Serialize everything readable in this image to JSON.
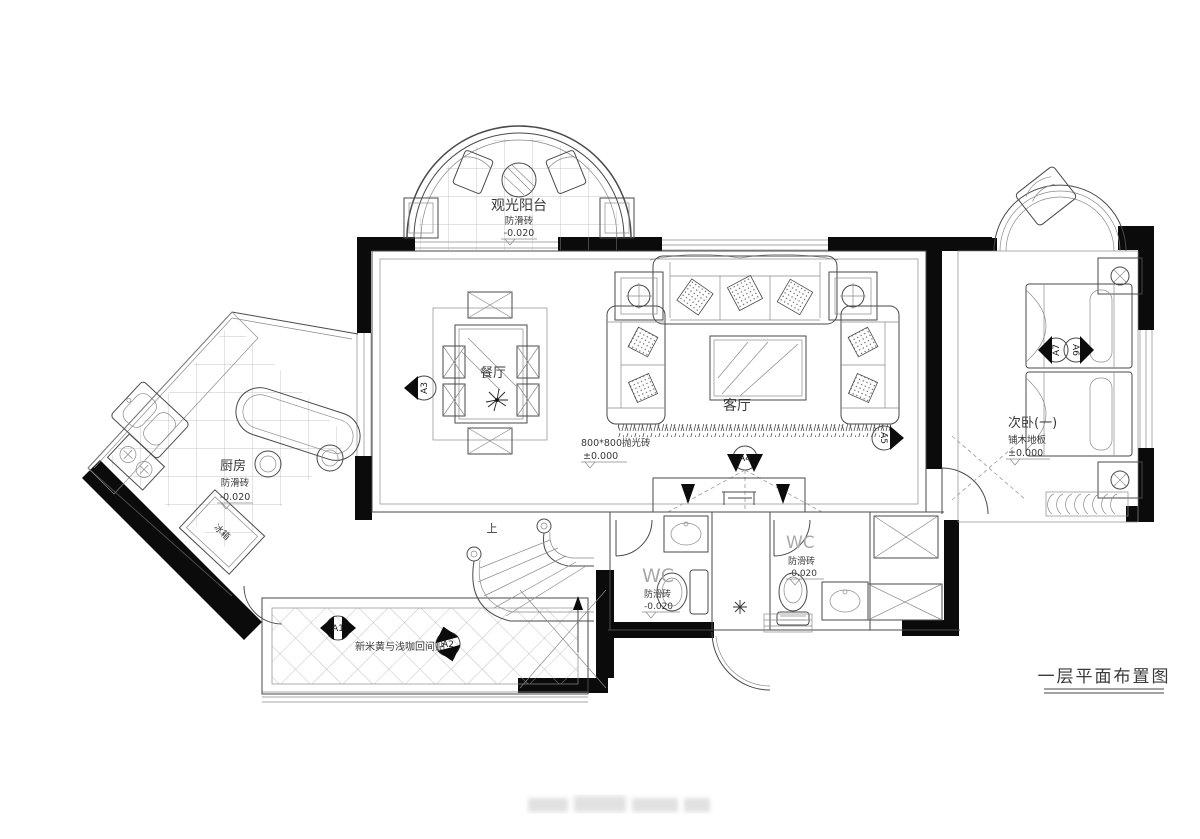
{
  "drawing": {
    "title": "一层平面布置图",
    "rooms": {
      "balcony": {
        "name": "观光阳台",
        "floor": "防滑砖",
        "level": "-0.020"
      },
      "dining": {
        "name": "餐厅"
      },
      "living": {
        "name": "客厅",
        "floor": "800*800抛光砖",
        "level": "±0.000"
      },
      "bedroom": {
        "name": "次卧(一)",
        "floor": "铺木地板",
        "level": "±0.000"
      },
      "kitchen": {
        "name": "厨房",
        "floor": "防滑砖",
        "level": "-0.020"
      },
      "wc_left": {
        "name": "WC",
        "floor": "防滑砖",
        "level": "-0.020"
      },
      "wc_right": {
        "name": "WC",
        "floor": "防滑砖",
        "level": "-0.020"
      },
      "hallway": {
        "floor": "新米黄与浅咖回间贴"
      }
    },
    "furniture": {
      "fridge": "冰箱"
    },
    "stairs": {
      "direction": "上"
    },
    "elevation_markers": {
      "a1": "A1",
      "a2": "A2",
      "a3": "A3",
      "a4": "A4",
      "a5": "A5",
      "a6": "A6",
      "a7": "A7"
    },
    "colors": {
      "line": "#4a4a4a",
      "wall": "#0b0b0b",
      "tile": "#b4b4b4",
      "text": "#3a3a3a",
      "muted": "#a8a8a8",
      "background": "#ffffff"
    }
  }
}
